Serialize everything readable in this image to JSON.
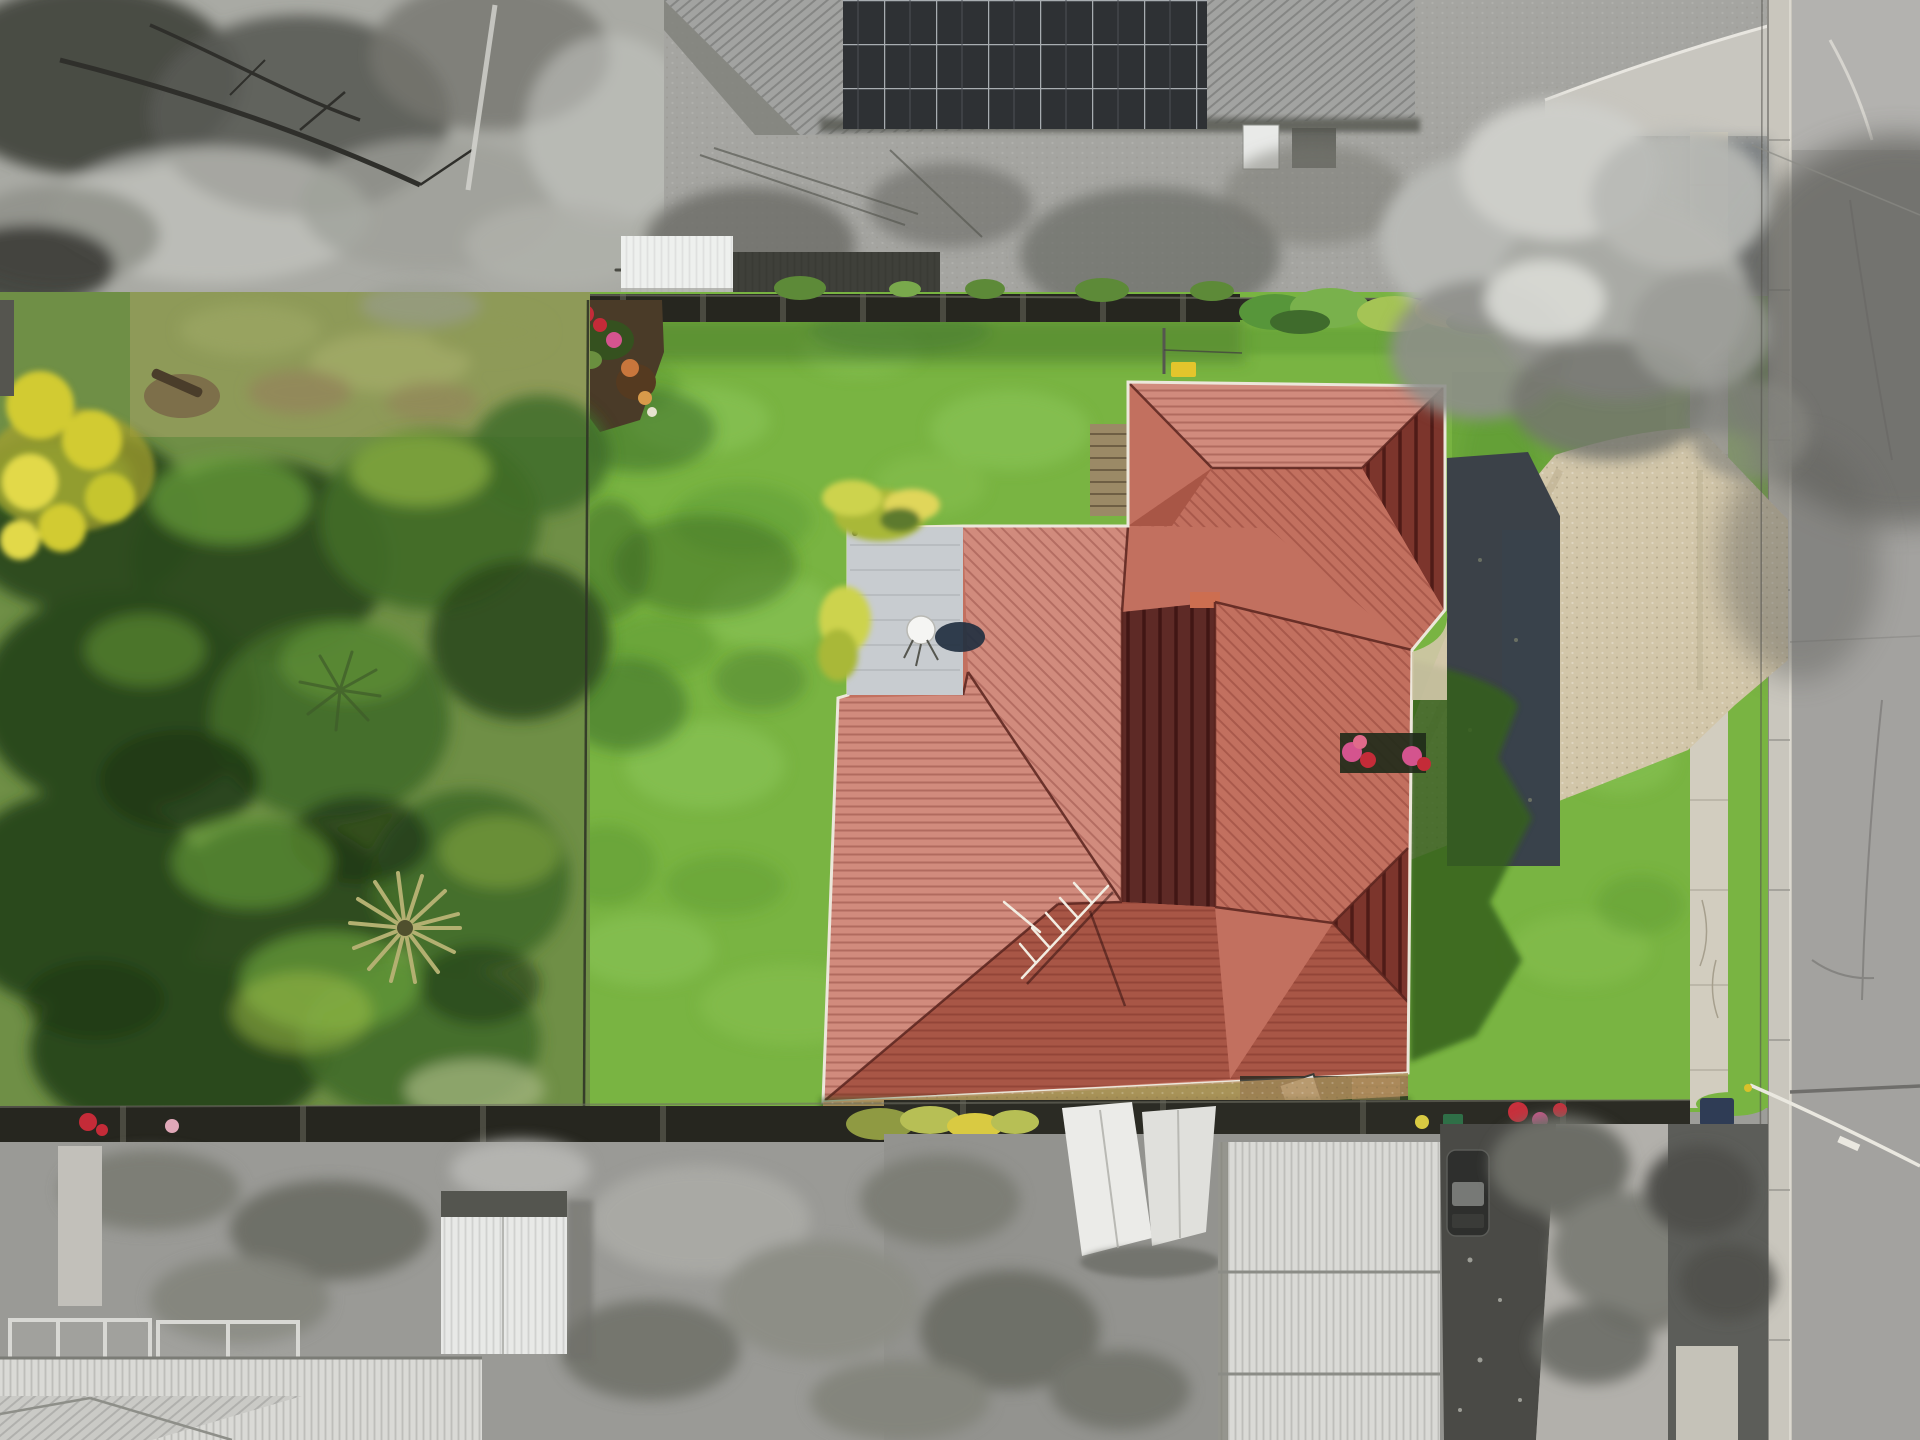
{
  "image": {
    "kind": "aerial drone photograph of a residential property",
    "technique": "selective colour real-estate composite: the subject block is shown in full colour while neighbouring properties, street and bottom/top strips are desaturated to grayscale",
    "orientation": "top-down (nadir) view, street running vertically on the right"
  },
  "scene": {
    "subject_property": "large grassed block with single-storey brick house, terracotta tiled hip roof, white flat patio roof with satellite dish, TV aerial, exposed-aggregate driveway, timber boundary fences, mature trees and palm on the left half of the block",
    "top_neighbour": "grayscale house with corrugated roof and large rooftop solar array, bare concrete backyard, white garden shed on the boundary",
    "bottom_neighbour": "grayscale house with white corrugated roofs, shade sails, dark driveway with parked car and heavily treed garden",
    "street": "asphalt road with concrete kerb and channel, footpath through grass verge, overhead service cables and large overhanging grayscale street tree casting shadow on the road"
  },
  "objects": [
    {
      "name": "house-roof",
      "label": "terracotta tiled hip roof"
    },
    {
      "name": "garage-roof",
      "label": "garage wing hip roof"
    },
    {
      "name": "patio-roof",
      "label": "white flat patio roof"
    },
    {
      "name": "satellite-dish",
      "label": "satellite dish with cast shadow"
    },
    {
      "name": "tv-antenna",
      "label": "TV aerial lying across roof"
    },
    {
      "name": "back-lawn",
      "label": "rear lawn"
    },
    {
      "name": "front-lawn",
      "label": "street-side lawn"
    },
    {
      "name": "wild-garden",
      "label": "overgrown treed garden"
    },
    {
      "name": "yellow-tree",
      "label": "golden wattle tree"
    },
    {
      "name": "palm-tree",
      "label": "fan palm"
    },
    {
      "name": "garden-bed",
      "label": "corner flower bed"
    },
    {
      "name": "timber-deck",
      "label": "timber walkway beside garage"
    },
    {
      "name": "clothesline",
      "label": "clothesline pole with yellow winder"
    },
    {
      "name": "wheelie-bin",
      "label": "green wheelie bin"
    },
    {
      "name": "fire-pit",
      "label": "round fire pit"
    },
    {
      "name": "driveway",
      "label": "exposed aggregate driveway"
    },
    {
      "name": "shadow-pad",
      "label": "shaded charcoal concrete pad"
    },
    {
      "name": "footpath",
      "label": "concrete footpath"
    },
    {
      "name": "road",
      "label": "asphalt road"
    },
    {
      "name": "solar-panels",
      "label": "rooftop solar array"
    },
    {
      "name": "garden-shed-white",
      "label": "white boundary shed"
    },
    {
      "name": "shade-sails",
      "label": "white shade sails"
    },
    {
      "name": "parked-car",
      "label": "parked car on neighbour driveway"
    },
    {
      "name": "overhanging-tree",
      "label": "grayscale street tree"
    },
    {
      "name": "boundary-fence",
      "label": "dark timber boundary fence"
    }
  ],
  "colors": {
    "bw_scrub": "#a9aaa4",
    "bw_canopy_dark": "#45463f",
    "bw_canopy_mid": "#75766f",
    "bw_canopy_light": "#c3c4bf",
    "neighbour_roof": "#a2a3a1",
    "neighbour_roof_dark": "#555650",
    "solar_panel": "#2e3134",
    "solar_frame": "#a8adb1",
    "shed_white": "#eef0ee",
    "shed_dark": "#3f403a",
    "yard_concrete": "#a5a5a1",
    "road_asphalt": "#a3a29f",
    "road_light": "#b5b4b0",
    "road_shadow": "#63635f",
    "kerb_concrete": "#c9c6bd",
    "footpath": "#d2cdbf",
    "cable_white": "#eae8e0",
    "lawn_base": "#79b442",
    "lawn_light": "#90ca5e",
    "lawn_dark": "#5c9833",
    "lawn_shadow": "#35611f",
    "verge_shadow": "#44505a",
    "wild_base": "#6f8f46",
    "wild_grass": "#8e9a58",
    "wild_brown": "#93865a",
    "tree_dark": "#2c4a1d",
    "tree_mid": "#416c28",
    "tree_light": "#69a03a",
    "tree_lime": "#9fc04a",
    "tree_yellow": "#d2cb33",
    "palm_frond": "#b3b071",
    "mulch": "#4a3b28",
    "flower_red": "#c42b38",
    "flower_pink": "#d4548e",
    "flower_orange": "#c8763c",
    "flower_yellow": "#d9ca42",
    "bin_green": "#2f6f47",
    "bin_blue": "#2f3c55",
    "fence_dark": "#26261f",
    "deck_timber": "#9b8a66",
    "roof_light": "#d18b7d",
    "roof_mid": "#c2705f",
    "roof_deep": "#a85646",
    "roof_dark": "#7c352c",
    "roof_shadow": "#5e2a26",
    "ridge": "#5a241e",
    "gutter_white": "#ece7db",
    "patio_roof": "#c8ccd0",
    "dish_white": "#f5f5f3",
    "dish_shadow": "#223040",
    "pad_charcoal": "#3b4148",
    "pad_blue": "#39434f",
    "driveway": "#d2c6a9",
    "driveway_dark": "#b3a687",
    "antenna_white": "#f2ede2",
    "car_dark": "#2e2f2d",
    "tarp_white": "#ebebe8",
    "neigh_roof_white": "#dadad6",
    "neigh_drive_dark": "#4a4a46",
    "brick_wall": "#8f7352",
    "chimney": "#cd6e50",
    "yellow_item": "#e3c52c",
    "firepit": "#7a4a32"
  }
}
